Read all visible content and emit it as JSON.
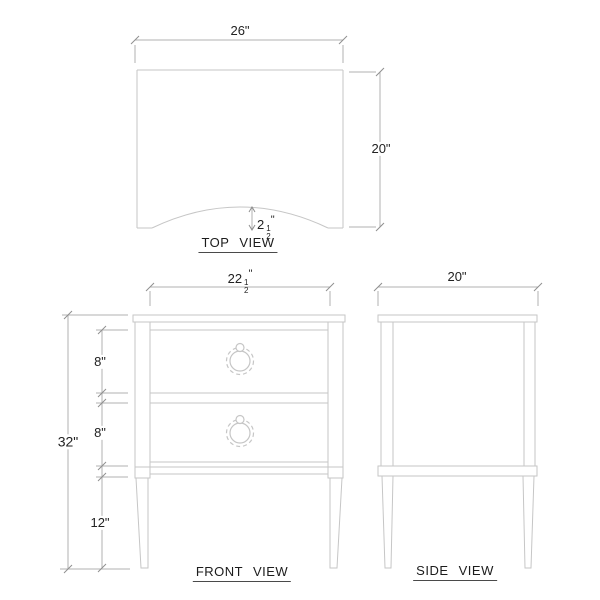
{
  "drawing": {
    "titles": {
      "top": "TOP VIEW",
      "front": "FRONT VIEW",
      "side": "SIDE VIEW"
    },
    "dimensions": {
      "top_width": "26\"",
      "top_depth": "20\"",
      "top_arc": {
        "whole": "2",
        "num": "1",
        "den": "2",
        "unit": "\""
      },
      "front_width": {
        "whole": "22",
        "num": "1",
        "den": "2",
        "unit": "\""
      },
      "front_drawer1": "8\"",
      "front_drawer2": "8\"",
      "front_leg": "12\"",
      "front_height": "32\"",
      "side_depth": "20\""
    },
    "colors": {
      "outline": "#c6c6c6",
      "dimension_line": "#b2b2b2",
      "tick": "#8f8f8f",
      "text": "#222222",
      "background": "#ffffff"
    }
  }
}
